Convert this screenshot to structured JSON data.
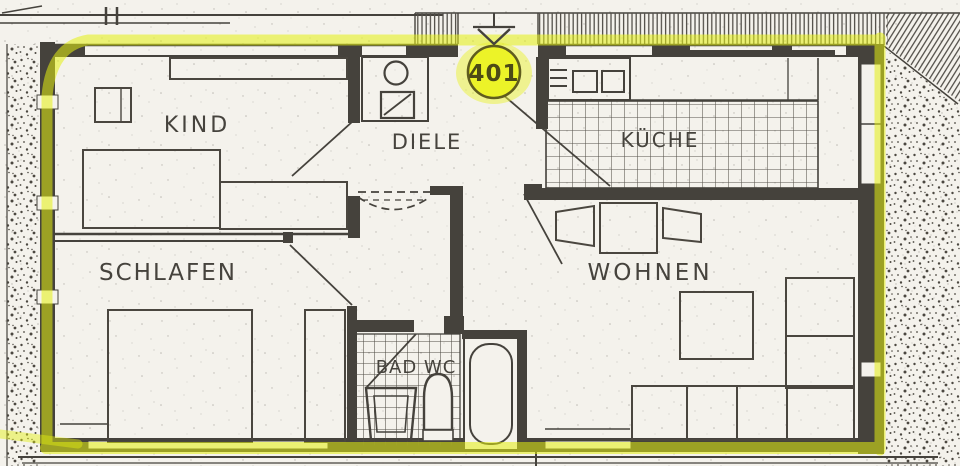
{
  "plan": {
    "unit_badge": {
      "number": "401"
    },
    "rooms": [
      {
        "id": "kind",
        "label": "KIND"
      },
      {
        "id": "diele",
        "label": "DIELE"
      },
      {
        "id": "kueche",
        "label": "KÜCHE"
      },
      {
        "id": "schlafen",
        "label": "SCHLAFEN"
      },
      {
        "id": "wohnen",
        "label": "WOHNEN"
      },
      {
        "id": "bad",
        "label": "BAD WC"
      }
    ],
    "fixtures": [
      "entrance-arrow-icon",
      "washing-machine-icon",
      "shower-icon",
      "stove-icon",
      "washbasin-icon",
      "toilet-icon",
      "bathtub-icon",
      "bed",
      "wardrobe",
      "desk",
      "dining-table",
      "chair",
      "coffee-table",
      "sofa"
    ],
    "colors": {
      "highlighter": "#e4f011",
      "badge_fill": "#ecf328",
      "ink": "#45423c",
      "paper": "#f4f2ec"
    }
  }
}
